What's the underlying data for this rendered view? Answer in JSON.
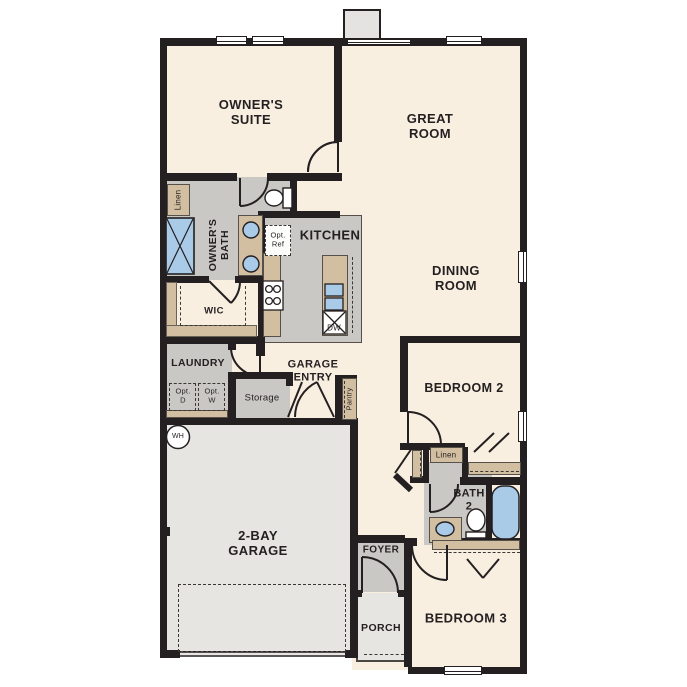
{
  "rooms": {
    "owners_suite": "OWNER'S\nSUITE",
    "great_room": "GREAT\nROOM",
    "dining_room": "DINING\nROOM",
    "kitchen": "KITCHEN",
    "owners_bath": "OWNER'S\nBATH",
    "wic": "WIC",
    "laundry": "LAUNDRY",
    "garage_entry": "GARAGE\nENTRY",
    "storage": "Storage",
    "pantry": "Pantry",
    "garage": "2-BAY\nGARAGE",
    "bedroom2": "BEDROOM 2",
    "bath2": "BATH\n2",
    "foyer": "FOYER",
    "porch": "PORCH",
    "bedroom3": "BEDROOM 3"
  },
  "fixtures": {
    "linen_owners": "Linen",
    "linen_hall": "Linen",
    "opt_ref": "Opt.\nRef",
    "opt_dryer": "Opt.\nD",
    "opt_washer": "Opt.\nW",
    "dishwasher": "DW",
    "water_heater": "WH"
  },
  "colors": {
    "wall": "#241f20",
    "floor_main": "#f8efe1",
    "floor_wet": "#c9c8c5",
    "floor_garage": "#e6e5e2",
    "counter_tan": "#d2bfa2",
    "fixture_blue": "#a9cbe8"
  }
}
